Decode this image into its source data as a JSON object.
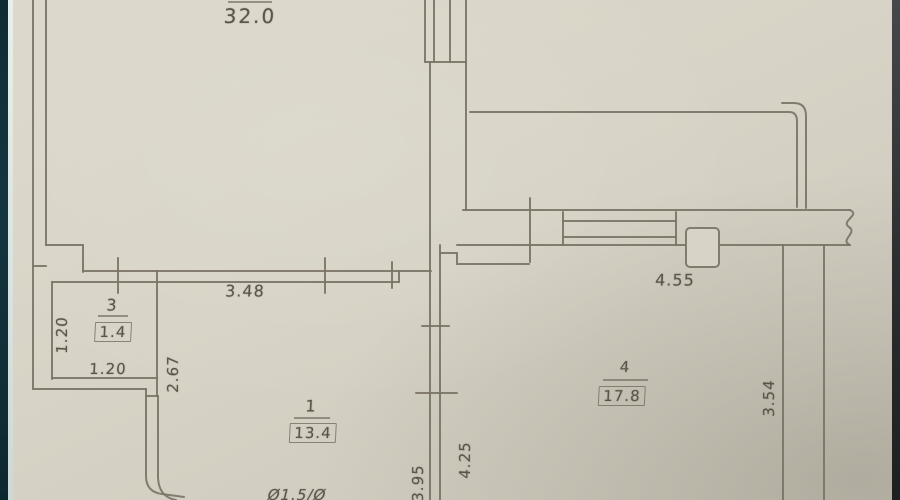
{
  "document": {
    "kind": "apartment floor plan (photograph of a drawing)",
    "units_note": "dimensions in meters, areas in square meters"
  },
  "palette": {
    "paper": "#d7d3c6",
    "line": "#797265",
    "text": "#595649",
    "left_edge_dark": "#143540",
    "left_edge_light": "#dce7e4",
    "right_edge_dark": "#2b2d2e"
  },
  "rooms": [
    {
      "number": "1",
      "area": "13.4"
    },
    {
      "number": "3",
      "area": "1.4"
    },
    {
      "number": "4",
      "area": "17.8"
    }
  ],
  "labels": {
    "area_top": "32.0",
    "dim_3_48": "3.48",
    "room3_num": "3",
    "room3_area": "1.4",
    "dim_1_20_v": "1.20",
    "dim_1_20_h": "1.20",
    "dim_2_67": "2.67",
    "room1_num": "1",
    "room1_area": "13.4",
    "pipe_note": "Ø1.5/Ø",
    "dim_4_55": "4.55",
    "room4_num": "4",
    "room4_area": "17.8",
    "dim_3_54": "3.54",
    "dim_4_25": "4.25",
    "dim_3_95": "3.95"
  },
  "dimensions": [
    {
      "value": "32.0",
      "orientation": "horizontal",
      "location": "top-left large room"
    },
    {
      "value": "3.48",
      "orientation": "horizontal",
      "location": "wall above room 1"
    },
    {
      "value": "1.20",
      "orientation": "vertical",
      "location": "room 3 left side"
    },
    {
      "value": "1.20",
      "orientation": "horizontal",
      "location": "room 3 bottom"
    },
    {
      "value": "2.67",
      "orientation": "vertical",
      "location": "right of room 3"
    },
    {
      "value": "4.55",
      "orientation": "horizontal",
      "location": "room 4 top wall"
    },
    {
      "value": "3.54",
      "orientation": "vertical",
      "location": "room 4 right side"
    },
    {
      "value": "4.25",
      "orientation": "vertical",
      "location": "room 4 left side"
    },
    {
      "value": "3.95",
      "orientation": "vertical",
      "location": "room 1 right side"
    }
  ]
}
